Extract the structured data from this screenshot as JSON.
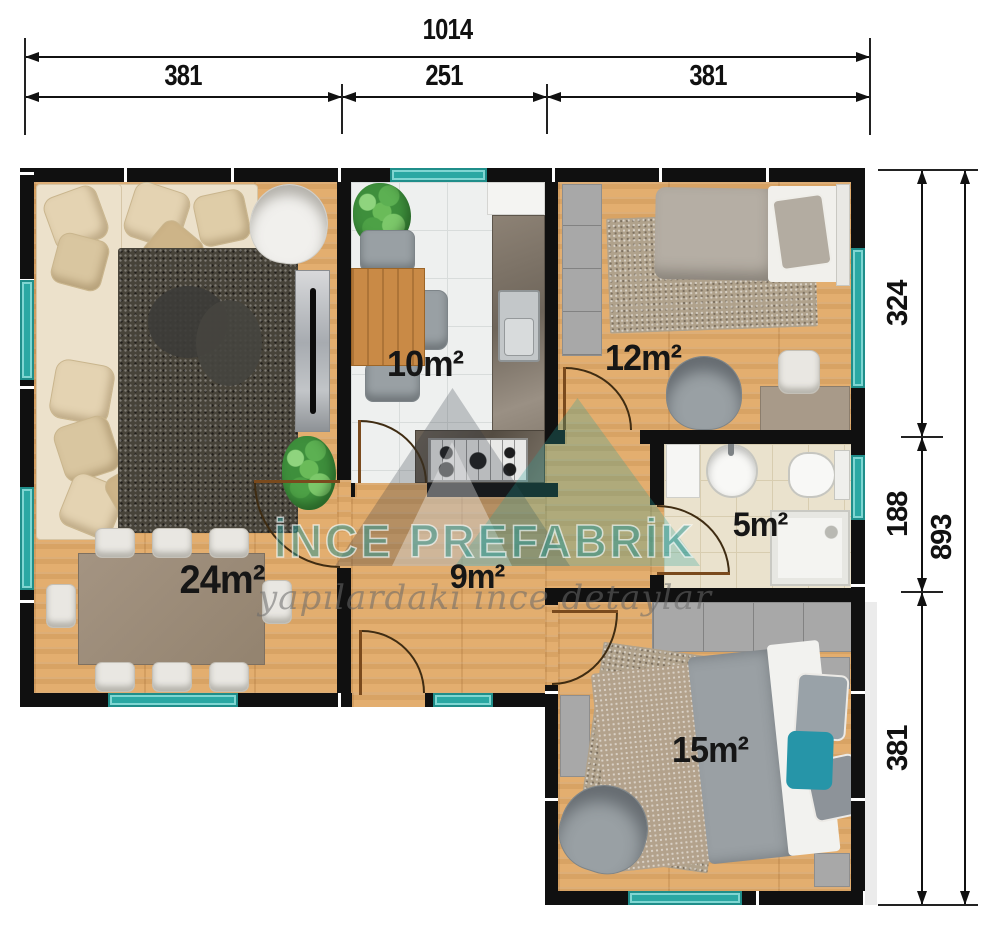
{
  "plan": {
    "title": "prefab-house-floor-plan",
    "dimensions_top": {
      "total": "1014",
      "segments": [
        "381",
        "251",
        "381"
      ]
    },
    "dimensions_right": {
      "segments": [
        "324",
        "188",
        "381"
      ],
      "total": "893"
    },
    "rooms": [
      {
        "name": "living-dining-room",
        "area_label": "24m²"
      },
      {
        "name": "kitchen",
        "area_label": "10m²"
      },
      {
        "name": "bedroom-1",
        "area_label": "12m²"
      },
      {
        "name": "bathroom",
        "area_label": "5m²"
      },
      {
        "name": "hallway",
        "area_label": "9m²"
      },
      {
        "name": "bedroom-2",
        "area_label": "15m²"
      }
    ],
    "watermark": {
      "brand": "İNCE PREFABRİK",
      "tagline": "yapılardaki ince detaylar"
    },
    "colors": {
      "wall": "#101010",
      "window_teal": "#2aa8a3",
      "wood_floor": "#e3ae6f",
      "kitchen_tile": "#eef0ef",
      "bath_tile": "#eae2cd",
      "watermark_teal": "#2aa8a3"
    }
  }
}
